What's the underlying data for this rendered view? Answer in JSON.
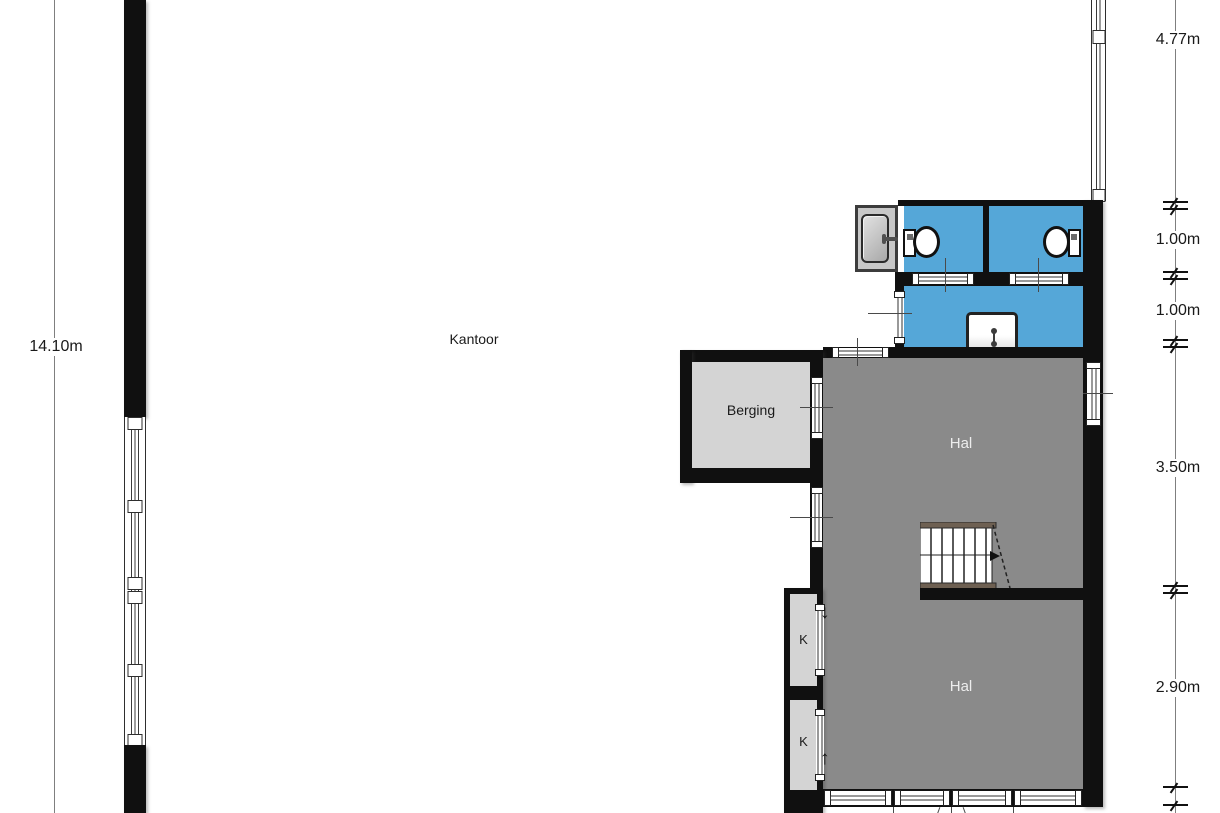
{
  "rooms": {
    "kantoor": {
      "label": "Kantoor"
    },
    "berging": {
      "label": "Berging"
    },
    "hal_upper": {
      "label": "Hal"
    },
    "hal_lower": {
      "label": "Hal"
    },
    "closet_top": {
      "label": "K"
    },
    "closet_bottom": {
      "label": "K"
    }
  },
  "dimensions": {
    "left": {
      "label": "14.10m"
    },
    "right": [
      {
        "label": "4.77m"
      },
      {
        "label": "1.00m"
      },
      {
        "label": "1.00m"
      },
      {
        "label": "3.50m"
      },
      {
        "label": "2.90m"
      }
    ]
  },
  "icons": {
    "arrow_down": "↓",
    "arrow_up": "↑"
  },
  "colors": {
    "wall": "#101010",
    "bathroom_blue": "#55a7d8",
    "hall_gray": "#8a8a8a",
    "room_light_gray": "#d4d4d4",
    "stair_strip": "#6e6052",
    "dimension_line": "#7f7f7f"
  }
}
